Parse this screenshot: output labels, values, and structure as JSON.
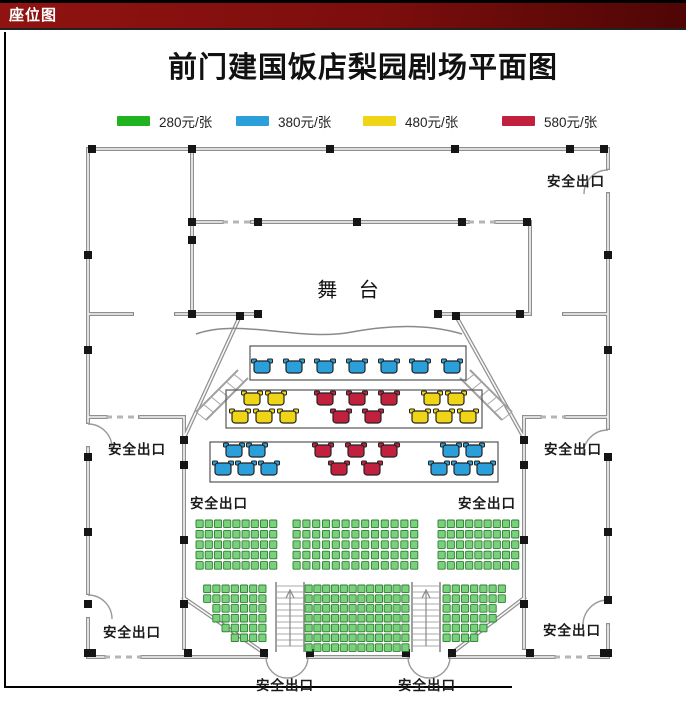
{
  "header": {
    "title": "座位图",
    "bar_color": "#7C0E0D"
  },
  "title": "前门建国饭店梨园剧场平面图",
  "legend": [
    {
      "label": "280元/张",
      "color": "#1FB41F"
    },
    {
      "label": "380元/张",
      "color": "#2B9FD9"
    },
    {
      "label": "480元/张",
      "color": "#F0D516"
    },
    {
      "label": "580元/张",
      "color": "#C1203E"
    }
  ],
  "plan": {
    "stage_label": "舞 台",
    "exit_label": "安全出口",
    "exit_positions": [
      {
        "x": 576,
        "y": 180
      },
      {
        "x": 137,
        "y": 448
      },
      {
        "x": 573,
        "y": 448
      },
      {
        "x": 219,
        "y": 502
      },
      {
        "x": 487,
        "y": 502
      },
      {
        "x": 132,
        "y": 631
      },
      {
        "x": 572,
        "y": 629
      },
      {
        "x": 285,
        "y": 684
      },
      {
        "x": 427,
        "y": 684
      }
    ],
    "colors": {
      "blue": "#2B9FD9",
      "yellow": "#F0D516",
      "red": "#C1203E",
      "green_fill": "#79D17B",
      "green_stroke": "#2E7D32",
      "outline": "#222222"
    },
    "table_boxes": [
      {
        "x": 250,
        "y": 346,
        "w": 216,
        "h": 34,
        "tables": [
          {
            "color": "blue",
            "x": 262,
            "y": 367
          },
          {
            "color": "blue",
            "x": 294,
            "y": 367
          },
          {
            "color": "blue",
            "x": 325,
            "y": 367
          },
          {
            "color": "blue",
            "x": 357,
            "y": 367
          },
          {
            "color": "blue",
            "x": 389,
            "y": 367
          },
          {
            "color": "blue",
            "x": 420,
            "y": 367
          },
          {
            "color": "blue",
            "x": 452,
            "y": 367
          }
        ]
      },
      {
        "x": 226,
        "y": 390,
        "w": 256,
        "h": 38,
        "tables": [
          {
            "color": "yellow",
            "x": 252,
            "y": 399
          },
          {
            "color": "yellow",
            "x": 276,
            "y": 399
          },
          {
            "color": "yellow",
            "x": 240,
            "y": 417
          },
          {
            "color": "yellow",
            "x": 264,
            "y": 417
          },
          {
            "color": "yellow",
            "x": 288,
            "y": 417
          },
          {
            "color": "red",
            "x": 325,
            "y": 399
          },
          {
            "color": "red",
            "x": 357,
            "y": 399
          },
          {
            "color": "red",
            "x": 389,
            "y": 399
          },
          {
            "color": "red",
            "x": 341,
            "y": 417
          },
          {
            "color": "red",
            "x": 373,
            "y": 417
          },
          {
            "color": "yellow",
            "x": 432,
            "y": 399
          },
          {
            "color": "yellow",
            "x": 456,
            "y": 399
          },
          {
            "color": "yellow",
            "x": 420,
            "y": 417
          },
          {
            "color": "yellow",
            "x": 444,
            "y": 417
          },
          {
            "color": "yellow",
            "x": 468,
            "y": 417
          }
        ]
      },
      {
        "x": 210,
        "y": 442,
        "w": 288,
        "h": 40,
        "tables": [
          {
            "color": "blue",
            "x": 234,
            "y": 451
          },
          {
            "color": "blue",
            "x": 257,
            "y": 451
          },
          {
            "color": "blue",
            "x": 223,
            "y": 469
          },
          {
            "color": "blue",
            "x": 246,
            "y": 469
          },
          {
            "color": "blue",
            "x": 269,
            "y": 469
          },
          {
            "color": "red",
            "x": 323,
            "y": 451
          },
          {
            "color": "red",
            "x": 356,
            "y": 451
          },
          {
            "color": "red",
            "x": 389,
            "y": 451
          },
          {
            "color": "red",
            "x": 339,
            "y": 469
          },
          {
            "color": "red",
            "x": 372,
            "y": 469
          },
          {
            "color": "blue",
            "x": 451,
            "y": 451
          },
          {
            "color": "blue",
            "x": 474,
            "y": 451
          },
          {
            "color": "blue",
            "x": 439,
            "y": 469
          },
          {
            "color": "blue",
            "x": 462,
            "y": 469
          },
          {
            "color": "blue",
            "x": 485,
            "y": 469
          }
        ]
      }
    ],
    "seat_blocks": [
      {
        "x": 196,
        "y": 520,
        "px": 9.2,
        "py": 10.4,
        "rows": [
          9,
          9,
          9,
          9,
          9
        ]
      },
      {
        "x": 293,
        "y": 520,
        "px": 9.8,
        "py": 10.4,
        "rows": [
          13,
          13,
          13,
          13,
          13
        ]
      },
      {
        "x": 438,
        "y": 520,
        "px": 9.2,
        "py": 10.4,
        "rows": [
          9,
          9,
          9,
          9,
          9
        ]
      },
      {
        "x": 268,
        "y": 585,
        "px": 9.2,
        "py": 9.8,
        "rows": [
          7,
          7,
          6,
          6,
          5,
          4
        ],
        "align": "right"
      },
      {
        "x": 305,
        "y": 585,
        "px": 8.8,
        "py": 9.8,
        "rows": [
          12,
          12,
          12,
          12,
          12,
          12,
          12
        ]
      },
      {
        "x": 443,
        "y": 585,
        "px": 9.2,
        "py": 9.8,
        "rows": [
          7,
          7,
          6,
          6,
          5,
          4
        ],
        "align": "left"
      }
    ]
  }
}
